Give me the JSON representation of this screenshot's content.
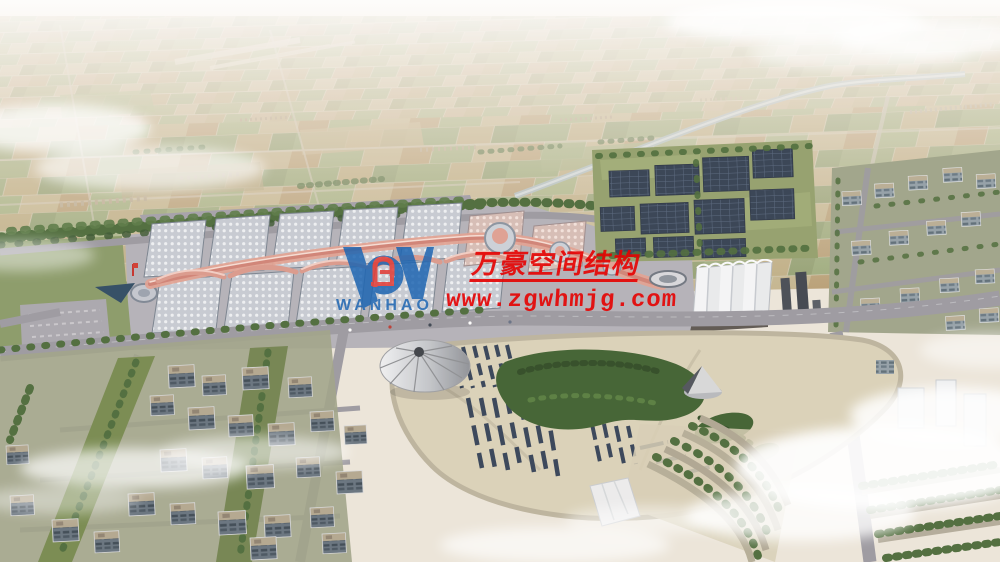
{
  "watermark": {
    "company_name": "万豪空间结构",
    "website": "www.zgwhmjg.com",
    "logo_wordmark": "WANHAO"
  },
  "palette": {
    "wm-red": "#e60202",
    "logo-blue": "#1e66b2",
    "logo-red": "#e23b35",
    "cloud-white": "#ffffff",
    "tree-green": "#4c6b3a",
    "solar-navy": "#344257",
    "forest-green": "#3f6030",
    "park-cream": "#dbd2b9",
    "road-gray": "#9b99a1",
    "canopy-pink": "#e2a191"
  }
}
